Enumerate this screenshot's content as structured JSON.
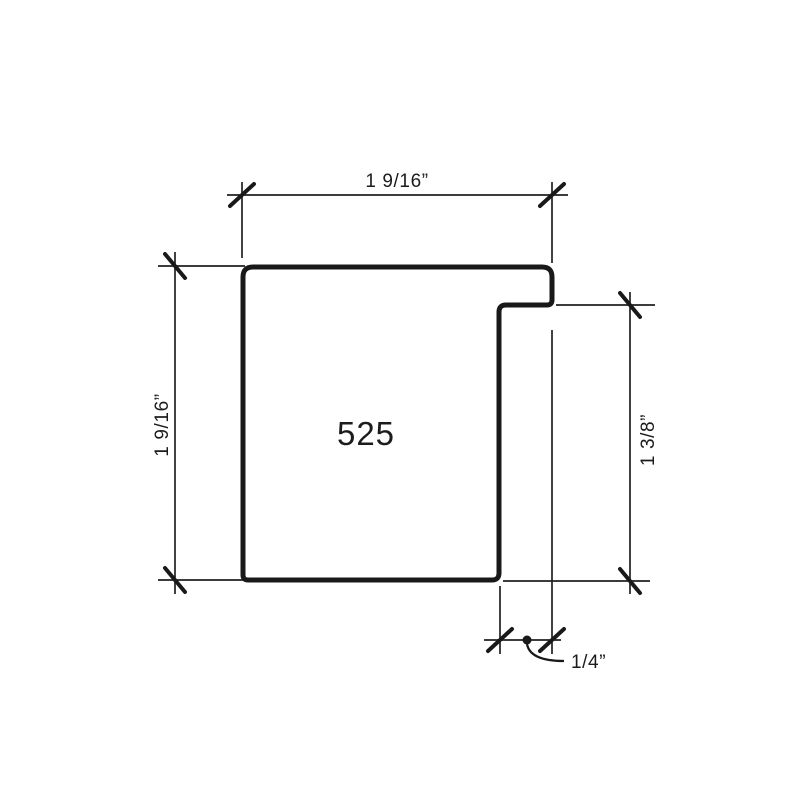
{
  "drawing": {
    "item_number": "525",
    "dimensions": {
      "top_width": "1 9/16”",
      "left_height": "1 9/16”",
      "right_rabbet_height": "1 3/8”",
      "bottom_rabbet_width": "1/4”"
    },
    "colors": {
      "line": "#191919",
      "background": "#ffffff"
    }
  }
}
